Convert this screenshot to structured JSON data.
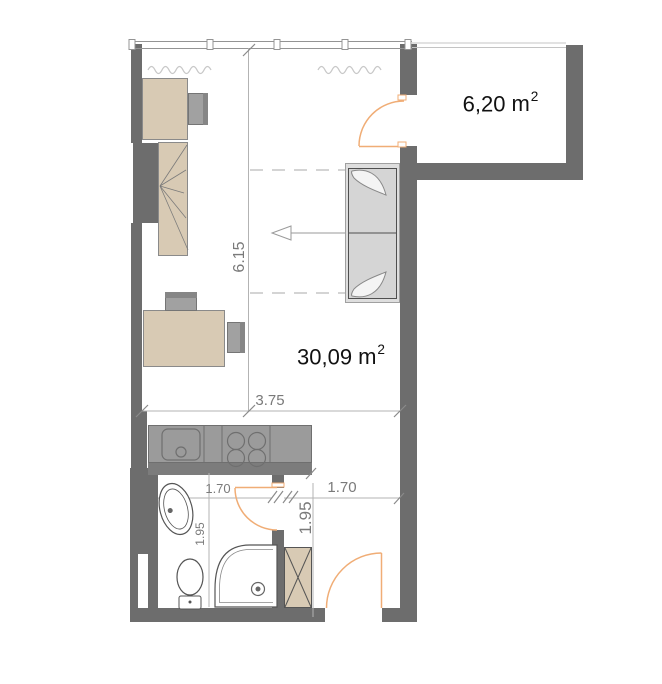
{
  "plan": {
    "rooms": {
      "living": {
        "area": "30,09",
        "unit": "m",
        "sup": "2"
      },
      "balcony": {
        "area": "6,20",
        "unit": "m",
        "sup": "2"
      }
    },
    "dims": {
      "room_height": "6.15",
      "room_width": "3.75",
      "bath_width": "1.70",
      "hall_width": "1.70",
      "bath_depth": "1.95",
      "hall_depth": "1.95"
    },
    "colors": {
      "wall": "#6d6d6d",
      "furniture_wood": "#d8cab4",
      "appliance_gray": "#9b9b9b",
      "door_accent": "#f0ad76",
      "dimension_text": "#7a7a7a",
      "label_text": "#111111"
    },
    "furniture": [
      "desk",
      "office-chair",
      "wardrobe",
      "bed-sofa",
      "kitchen-counter",
      "sink",
      "stove",
      "washbasin",
      "toilet",
      "corner-shower",
      "hall-cabinet",
      "radiator",
      "entrance-door",
      "bathroom-door",
      "balcony-door"
    ]
  }
}
